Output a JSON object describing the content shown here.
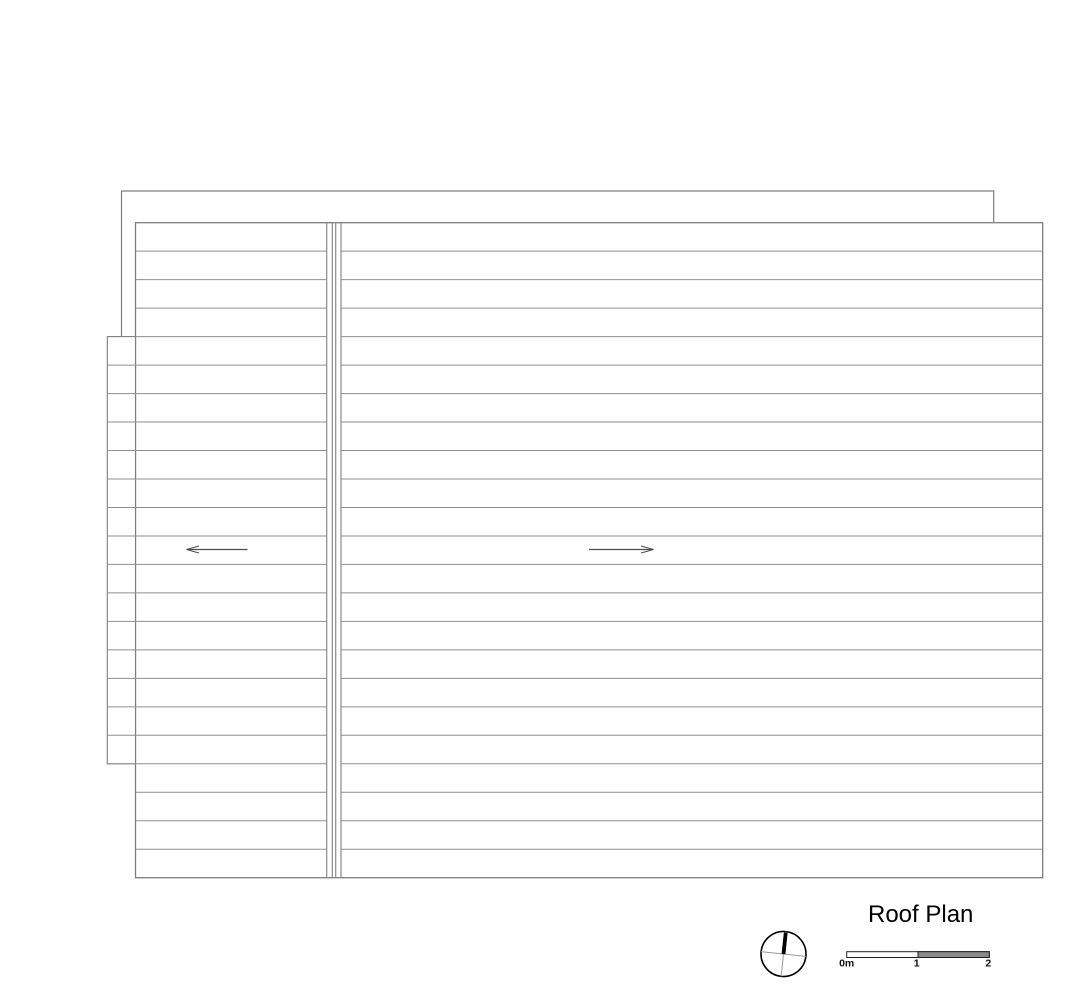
{
  "title": {
    "label": "Roof Plan"
  },
  "colors": {
    "paper": "#ffffff",
    "outline": "#7d7d7d",
    "sheet_line": "#8f8f8f",
    "ridge_line": "#8a8a8a",
    "arrow": "#4d4d4d",
    "compass_cross": "#999999",
    "compass_ink": "#000000",
    "scale_fill": "#8a8a8a",
    "scale_stroke": "#222222",
    "text_ink": "#000000"
  },
  "plan": {
    "canvas": {
      "w": 1087,
      "h": 1000
    },
    "background_outline": {
      "x": 121.5,
      "y": 191,
      "w": 872.2,
      "h": 509
    },
    "main_roof": {
      "x": 135.5,
      "y": 222.7,
      "w": 907.2,
      "h": 655
    },
    "left_overhang": {
      "x": 107.3,
      "y": 336.6,
      "w": 28.2,
      "h": 427.2
    },
    "sheet_lines": {
      "count": 22,
      "spacing": 28.478,
      "start_y": 222.7
    },
    "ridge": {
      "left_edge_x": 326.7,
      "inner_x1": 332.3,
      "inner_x2": 335.7,
      "right_edge_x": 341
    },
    "slope_arrows": [
      {
        "name": "slope-arrow-left",
        "direction": "left",
        "tip_x": 186.5,
        "tail_x": 247.5,
        "y": 549.5
      },
      {
        "name": "slope-arrow-right",
        "direction": "right",
        "tip_x": 653.5,
        "tail_x": 589,
        "y": 549.5
      }
    ],
    "arrow_head": {
      "length": 12.5,
      "half_width": 3.5
    }
  },
  "north_arrow": {
    "cx": 783.5,
    "cy": 954,
    "r": 22.5,
    "rotation_deg": 6,
    "bar_width": 3.8
  },
  "scale_bar": {
    "x": 846.7,
    "y": 951.7,
    "w": 142.6,
    "h": 5.8,
    "label_y": 966.5,
    "labels": [
      {
        "text": "0m",
        "x": 846.7
      },
      {
        "text": "1",
        "x": 916.7
      },
      {
        "text": "2",
        "x": 988.3
      }
    ]
  }
}
